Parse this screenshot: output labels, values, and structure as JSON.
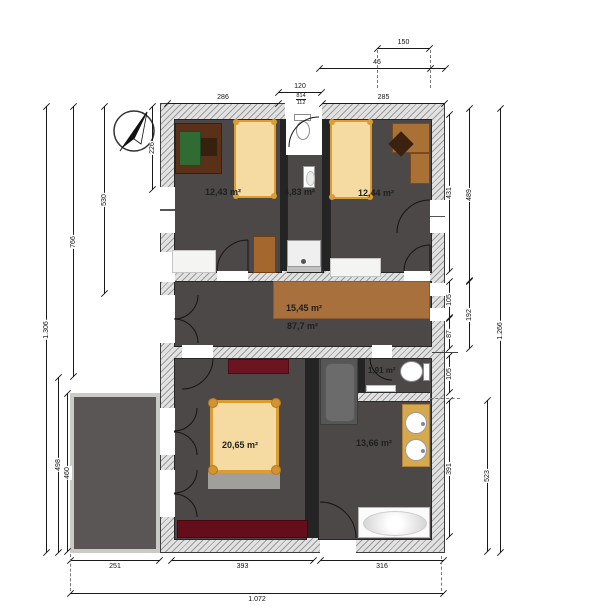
{
  "areas": {
    "room1": "12,43 m²",
    "bath_top": "4,83 m²",
    "room2": "12,44 m²",
    "landing": "15,45 m²",
    "floor_total": "87,7 m²",
    "wc": "1,91 m²",
    "bedroom": "20,65 m²",
    "bathroom": "13,66 m²"
  },
  "dims": {
    "win_width": "150",
    "win_offset": "46",
    "bath_width": "120",
    "spec_top": "814",
    "spec_bottom": "112",
    "room1_width": "286",
    "room2_width": "285",
    "left_total": "1.306",
    "left_upper": "766",
    "left_room": "530",
    "left_top": "226",
    "left_lower": "498",
    "terrace_h": "460",
    "terrace_w": "251",
    "bedroom_w": "393",
    "bath_w": "316",
    "bottom_total": "1.072",
    "r_room": "431",
    "r_upper": "489",
    "r_hall_a": "105",
    "r_hall": "192",
    "r_hall_b": "87",
    "r_wc": "105",
    "r_bath": "391",
    "r_lower": "523",
    "right_total": "1.266"
  },
  "colors": {
    "floor_dark": "#4b4847",
    "wall_hatch": "#e2e2e2",
    "wood_landing": "#a8703c",
    "bed_fill": "#f5dba2",
    "bed_frame": "#db9c33",
    "dresser_red": "#6d1421",
    "desk_dark_brown": "#5a3018",
    "desk_pad_green": "#2f6b33",
    "vanity_gold": "#d7a94f",
    "terrace_gray": "#595655"
  }
}
